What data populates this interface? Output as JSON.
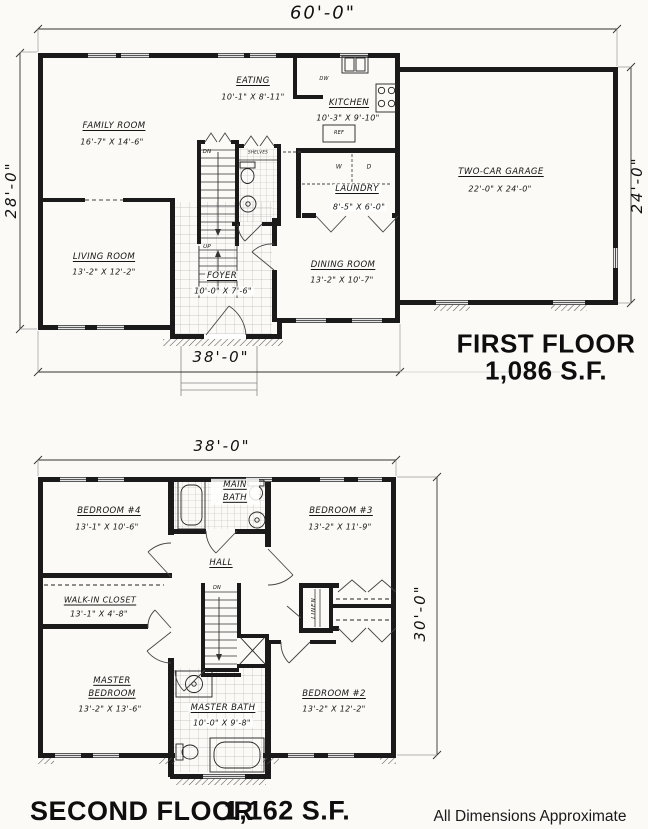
{
  "page": {
    "background": "#fbfaf7",
    "ink": "#1a1a1a"
  },
  "first_floor": {
    "title": "FIRST FLOOR",
    "area": "1,086 S.F.",
    "dim_top": "60'-0\"",
    "dim_left": "28'-0\"",
    "dim_right": "24'-0\"",
    "dim_bottom": "38'-0\"",
    "rooms": {
      "family": {
        "name": "FAMILY ROOM",
        "dims": "16'-7\" X 14'-6\""
      },
      "eating": {
        "name": "EATING",
        "dims": "10'-1\" X 8'-11\""
      },
      "kitchen": {
        "name": "KITCHEN",
        "dims": "10'-3\" X 9'-10\""
      },
      "living": {
        "name": "LIVING ROOM",
        "dims": "13'-2\" X 12'-2\""
      },
      "foyer": {
        "name": "FOYER",
        "dims": "10'-0\" X 7'-6\""
      },
      "dining": {
        "name": "DINING ROOM",
        "dims": "13'-2\" X 10'-7\""
      },
      "laundry": {
        "name": "LAUNDRY",
        "dims": "8'-5\" X 6'-0\""
      },
      "garage": {
        "name": "TWO-CAR GARAGE",
        "dims": "22'-0\" X 24'-0\""
      }
    },
    "labels": {
      "dn": "DN",
      "up": "UP",
      "dw": "DW",
      "ref": "REF",
      "washer": "W",
      "dryer": "D",
      "shelves": "SHELVES"
    }
  },
  "second_floor": {
    "title": "SECOND FLOOR",
    "area": "1,162 S.F.",
    "dim_top": "38'-0\"",
    "dim_right": "30'-0\"",
    "rooms": {
      "bedroom4": {
        "name": "BEDROOM #4",
        "dims": "13'-1\" X 10'-6\""
      },
      "main_bath": {
        "name": "MAIN BATH",
        "dims": ""
      },
      "bedroom3": {
        "name": "BEDROOM #3",
        "dims": "13'-2\" X 11'-9\""
      },
      "hall": {
        "name": "HALL",
        "dims": ""
      },
      "walkin_closet": {
        "name": "WALK-IN CLOSET",
        "dims": "13'-1\" X 4'-8\""
      },
      "master": {
        "name": "MASTER BEDROOM",
        "dims": "13'-2\" X 13'-6\""
      },
      "master_bath": {
        "name": "MASTER BATH",
        "dims": "10'-0\" X 9'-8\""
      },
      "bedroom2": {
        "name": "BEDROOM #2",
        "dims": "13'-2\" X 12'-2\""
      }
    },
    "labels": {
      "dn": "DN",
      "linen": "LINEN"
    }
  },
  "footnote": "All Dimensions Approximate"
}
